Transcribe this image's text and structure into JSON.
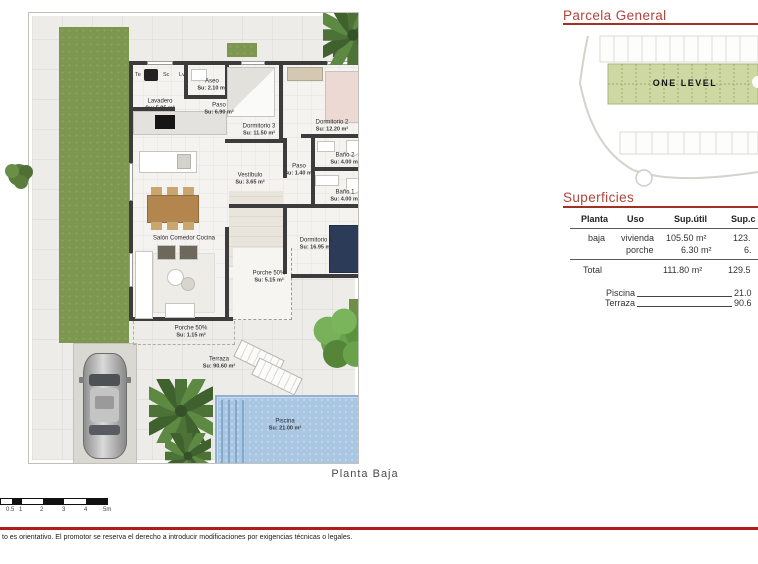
{
  "parcela": {
    "title": "Parcela  General",
    "site_label": "ONE LEVEL"
  },
  "superficies": {
    "title": "Superficies",
    "table": {
      "col_planta": "Planta",
      "col_uso": "Uso",
      "col_util": "Sup.útil",
      "col_construida": "Sup.c",
      "rows": [
        {
          "planta": "baja",
          "uso": "vivienda",
          "util": "105.50 m²",
          "cons": "123."
        },
        {
          "planta": "",
          "uso": "porche",
          "util": "6.30 m²",
          "cons": "6."
        }
      ],
      "total_label": "Total",
      "total_util": "111.80 m²",
      "total_cons": "129.5"
    },
    "extras": [
      {
        "label": "Piscina",
        "value": "21.0"
      },
      {
        "label": "Terraza",
        "value": "90.6"
      }
    ]
  },
  "plan": {
    "caption": "Planta  Baja",
    "appliances": [
      "Te",
      "Sc",
      "Lv"
    ],
    "rooms": [
      {
        "name": "Lavadero",
        "area": "Su: 5.95 m²"
      },
      {
        "name": "Aseo",
        "area": "Su: 2.10 m²"
      },
      {
        "name": "Paso",
        "area": "Su: 6.90 m²"
      },
      {
        "name": "Dormitorio 3",
        "area": "Su: 11.50 m²"
      },
      {
        "name": "Dormitorio 2",
        "area": "Su: 12.20 m²"
      },
      {
        "name": "Baño 2",
        "area": "Su: 4.00 m²"
      },
      {
        "name": "Paso",
        "area": "Su: 1.40 m²"
      },
      {
        "name": "Baño 1",
        "area": "Su: 4.00 m²"
      },
      {
        "name": "Vestíbulo",
        "area": "Su: 3.65 m²"
      },
      {
        "name": "Dormitorio 1",
        "area": "Su: 16.95 m²"
      },
      {
        "name": "Salón Comedor Cocina",
        "area": ""
      },
      {
        "name": "Porche 50%",
        "area": "Su: 5.15 m²"
      },
      {
        "name": "Porche 50%",
        "area": "Su: 1.15 m²"
      },
      {
        "name": "Terraza",
        "area": "Su: 90.60 m²"
      },
      {
        "name": "Piscina",
        "area": "Su: 21.00 m²"
      }
    ]
  },
  "scalebar": {
    "labels": [
      "0",
      "0.5",
      "1",
      "2",
      "3",
      "4",
      "5m"
    ]
  },
  "footer": {
    "disclaimer": "to es orientativo. El promotor se reserva el derecho a introducir modificaciones por exigencias técnicas o legales."
  },
  "colors": {
    "accent_red": "#b0453c",
    "plot_green": "#cdd8a3",
    "grass_green": "#7d9750",
    "pool_blue": "#a9c6e2",
    "wall_gray": "#3c3c3c"
  }
}
